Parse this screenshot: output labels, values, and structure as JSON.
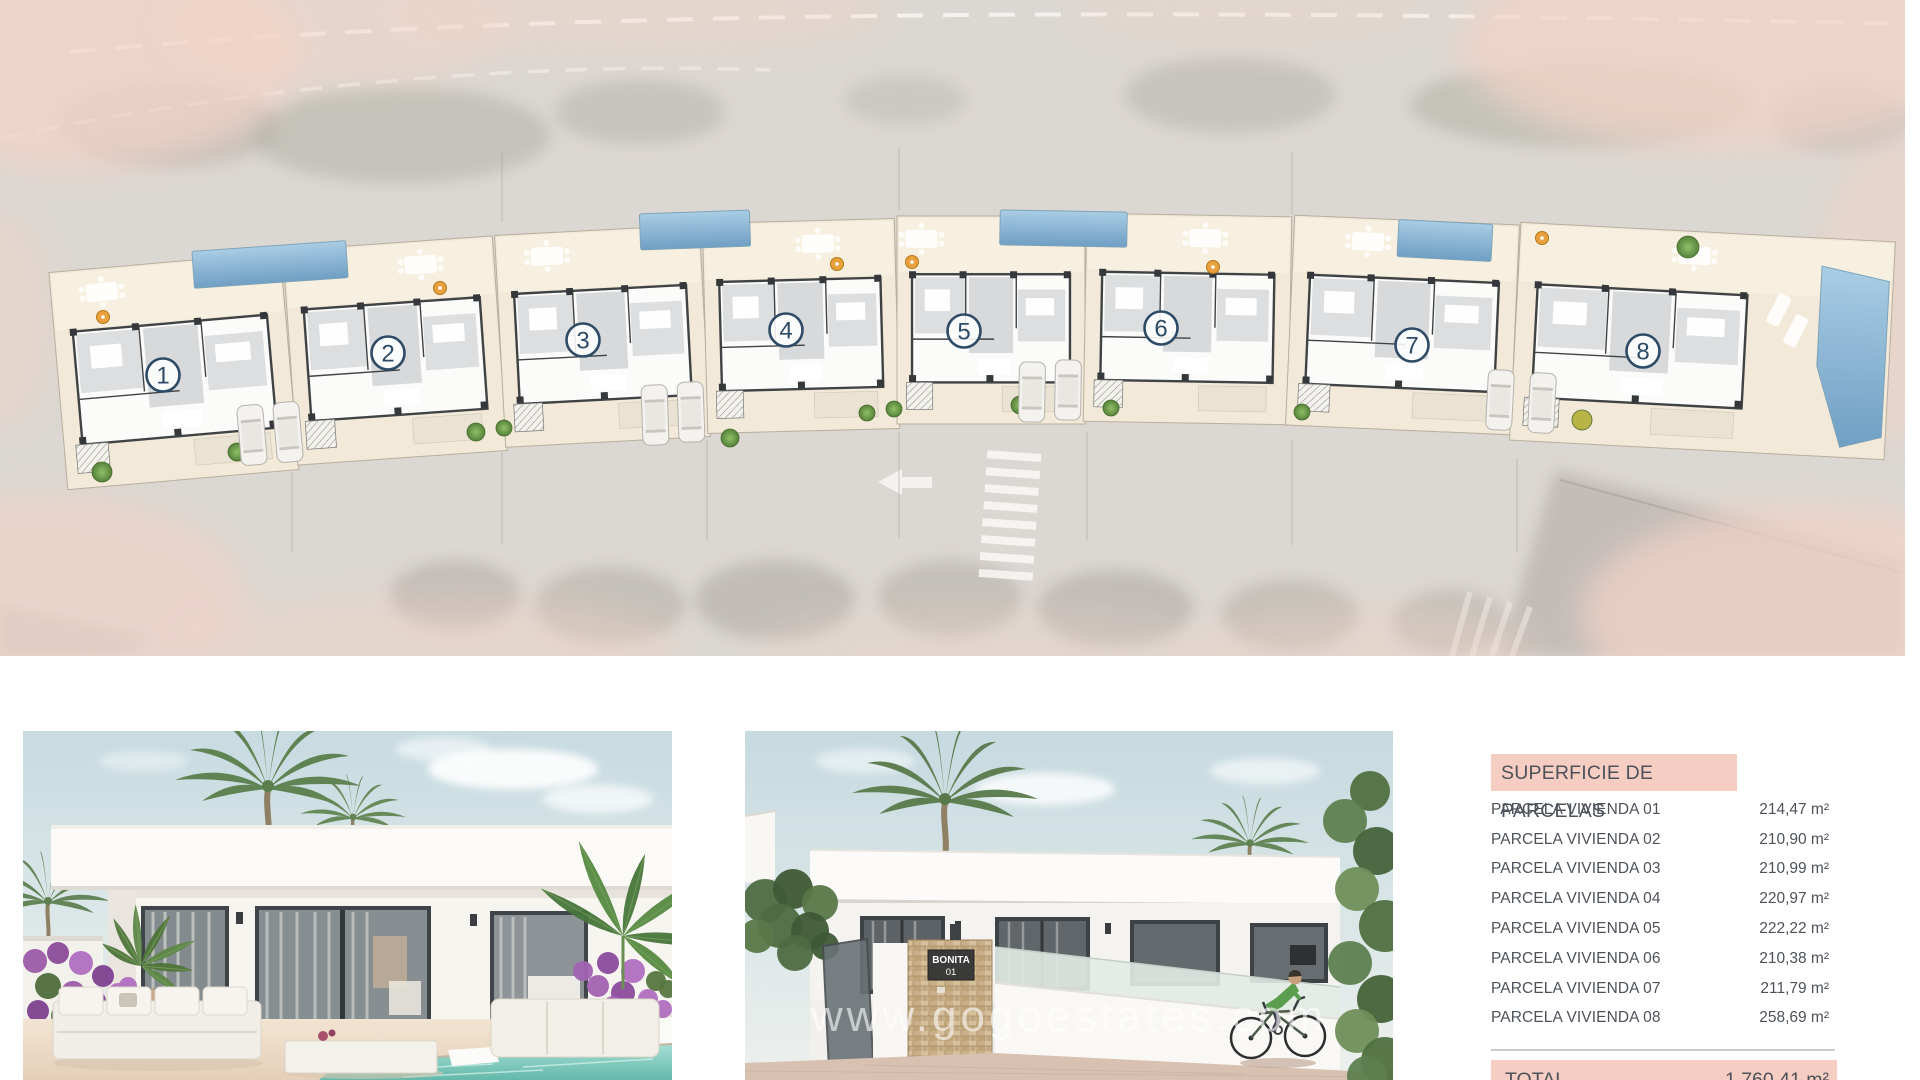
{
  "site_plan": {
    "units": [
      {
        "label": "1",
        "x": 58,
        "top": 262,
        "w": 232,
        "h": 218,
        "rot": -5,
        "cx": 163,
        "cy": 375,
        "tfrac": 0.22
      },
      {
        "label": "2",
        "x": 290,
        "top": 243,
        "w": 210,
        "h": 215,
        "rot": -4,
        "cx": 388,
        "cy": 353,
        "tfrac": 0.65
      },
      {
        "label": "3",
        "x": 500,
        "top": 230,
        "w": 205,
        "h": 212,
        "rot": -3,
        "cx": 583,
        "cy": 340,
        "tfrac": 0.25
      },
      {
        "label": "4",
        "x": 705,
        "top": 221,
        "w": 192,
        "h": 210,
        "rot": -1.5,
        "cx": 786,
        "cy": 330,
        "tfrac": 0.6
      },
      {
        "label": "5",
        "x": 897,
        "top": 216,
        "w": 188,
        "h": 208,
        "rot": 0,
        "cx": 964,
        "cy": 331,
        "tfrac": 0.13
      },
      {
        "label": "6",
        "x": 1085,
        "top": 215,
        "w": 205,
        "h": 208,
        "rot": 1,
        "cx": 1161,
        "cy": 328,
        "tfrac": 0.58
      },
      {
        "label": "7",
        "x": 1290,
        "top": 220,
        "w": 225,
        "h": 210,
        "rot": 2.5,
        "cx": 1412,
        "cy": 345,
        "tfrac": 0.33
      },
      {
        "label": "8",
        "x": 1515,
        "top": 232,
        "w": 375,
        "h": 218,
        "rot": 3,
        "cx": 1643,
        "cy": 351,
        "tfrac": 0.7,
        "wide": true
      }
    ]
  },
  "photos": {
    "watermark": "www.gogoestates.com",
    "entrance_sign": {
      "line1": "BONITA",
      "line2": "01"
    }
  },
  "table": {
    "title": "SUPERFICIE DE PARCELAS",
    "rows": [
      {
        "label": "PARCELA VIVIENDA 01",
        "value": "214,47 m²"
      },
      {
        "label": "PARCELA VIVIENDA 02",
        "value": "210,90 m²"
      },
      {
        "label": "PARCELA VIVIENDA 03",
        "value": "210,99 m²"
      },
      {
        "label": "PARCELA VIVIENDA 04",
        "value": "220,97 m²"
      },
      {
        "label": "PARCELA VIVIENDA 05",
        "value": "222,22 m²"
      },
      {
        "label": "PARCELA VIVIENDA 06",
        "value": "210,38 m²"
      },
      {
        "label": "PARCELA VIVIENDA 07",
        "value": "211,79 m²"
      },
      {
        "label": "PARCELA VIVIENDA 08",
        "value": "258,69 m²"
      }
    ],
    "total_label": "TOTAL",
    "total_value": "1.760,41 m²"
  },
  "colors": {
    "highlight_pink": "#f6cdc2",
    "table_text": "#4d525a",
    "badge_navy": "#2d4b66",
    "parcel_cream": "#f2e9d8",
    "pool_blue": "#6f9fc4",
    "tree_green": "#5f8c3c"
  }
}
